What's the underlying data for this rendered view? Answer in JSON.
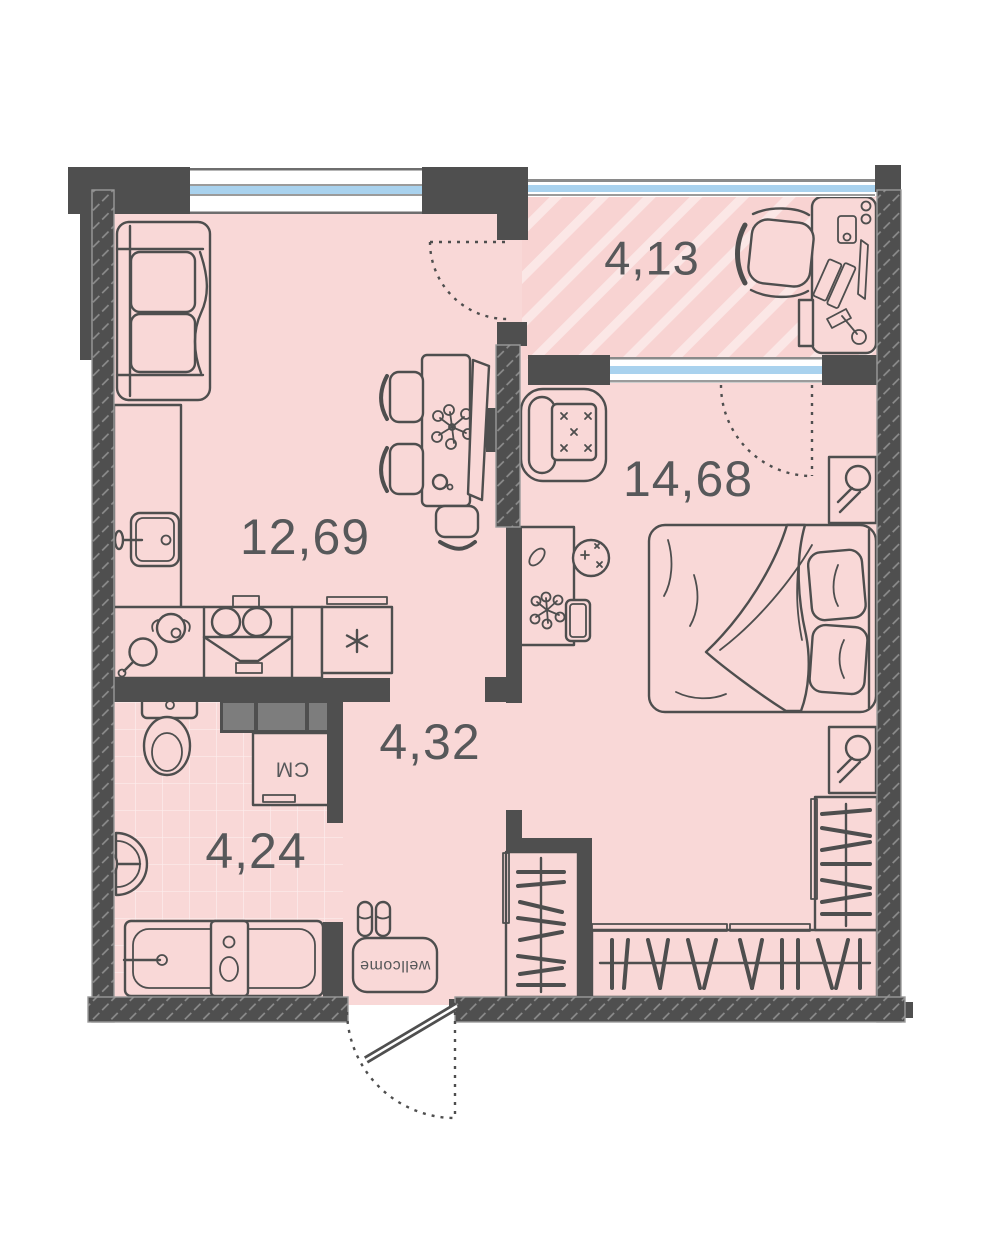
{
  "plan": {
    "rooms": {
      "kitchen_living": {
        "area": "12,69"
      },
      "loggia": {
        "area": "4,13"
      },
      "bedroom": {
        "area": "14,68"
      },
      "hallway": {
        "area": "4,32"
      },
      "bathroom": {
        "area": "4,24"
      }
    },
    "annotations": {
      "washing_machine": "СМ",
      "doormat": "wellcome"
    },
    "colors": {
      "floor": "#f9d8d7",
      "wall": "#4f4f4f",
      "hatchline": "#8f8f8f",
      "glazing": "#a9d2ee",
      "stripe": "#fbe7e6",
      "stripebase": "#f8d3d2",
      "labeltext": "#57585a",
      "line": "#4e4e4e"
    }
  }
}
